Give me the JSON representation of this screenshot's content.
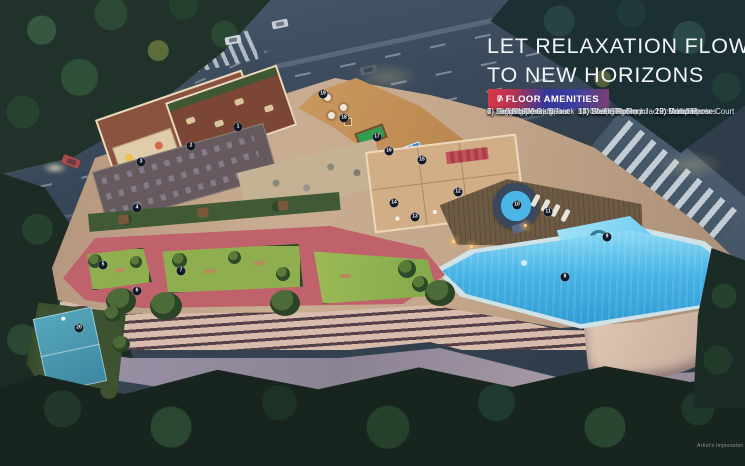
{
  "header": {
    "title_line1": "LET RELAXATION FLOW",
    "title_line2": "TO NEW HORIZONS",
    "badge": {
      "floor": "7",
      "ordinal": "th",
      "text": " FLOOR AMENITIES"
    }
  },
  "amenities": {
    "column1": [
      "1) Kids Creativity Space",
      "2) Kids Play Area",
      "3) Crèche",
      "4) Hi-Tech Gym",
      "5) Senior Citizen Sit-out",
      "6) Jogging/Walking Track",
      "7) Landscape Garden"
    ],
    "column2": [
      "8) Infinity Pool",
      "9) Kids Pool",
      "10) Water Therapy Jacuzzi",
      "11) Pool Side Deck",
      "12) Locker Room",
      "13) Changing Room",
      "14) Steam Room"
    ],
    "column3": [
      "15) Table Tennis",
      "16) Foosball",
      "17) Snooker",
      "18) Carrom",
      "19) Board Games",
      "20) Multipurpose Court"
    ]
  },
  "markers": [
    {
      "num": "1",
      "x": 238,
      "y": 127
    },
    {
      "num": "2",
      "x": 191,
      "y": 146
    },
    {
      "num": "3",
      "x": 141,
      "y": 162
    },
    {
      "num": "4",
      "x": 137,
      "y": 208
    },
    {
      "num": "5",
      "x": 103,
      "y": 265
    },
    {
      "num": "6",
      "x": 137,
      "y": 291
    },
    {
      "num": "7",
      "x": 181,
      "y": 271
    },
    {
      "num": "8",
      "x": 565,
      "y": 277
    },
    {
      "num": "9",
      "x": 607,
      "y": 237
    },
    {
      "num": "10",
      "x": 517,
      "y": 205
    },
    {
      "num": "11",
      "x": 548,
      "y": 212
    },
    {
      "num": "12",
      "x": 458,
      "y": 192
    },
    {
      "num": "13",
      "x": 415,
      "y": 217
    },
    {
      "num": "14",
      "x": 394,
      "y": 203
    },
    {
      "num": "15",
      "x": 422,
      "y": 160
    },
    {
      "num": "16",
      "x": 389,
      "y": 151
    },
    {
      "num": "17",
      "x": 377,
      "y": 137
    },
    {
      "num": "18",
      "x": 344,
      "y": 118
    },
    {
      "num": "19",
      "x": 323,
      "y": 94
    },
    {
      "num": "20",
      "x": 79,
      "y": 328
    }
  ],
  "footer": {
    "disclaimer": "Artist's Impression"
  },
  "colors": {
    "badge_gradient_start": "#d63845",
    "badge_gradient_mid": "#35389b",
    "badge_gradient_end": "#7c3f72",
    "marker_bg": "#0f1827",
    "pool_water": "#49b4e6",
    "jogging_track": "#c0626c",
    "lawn": "#8fae4f",
    "roof": "#c3a68b",
    "headline_text": "#f2f6f8"
  }
}
